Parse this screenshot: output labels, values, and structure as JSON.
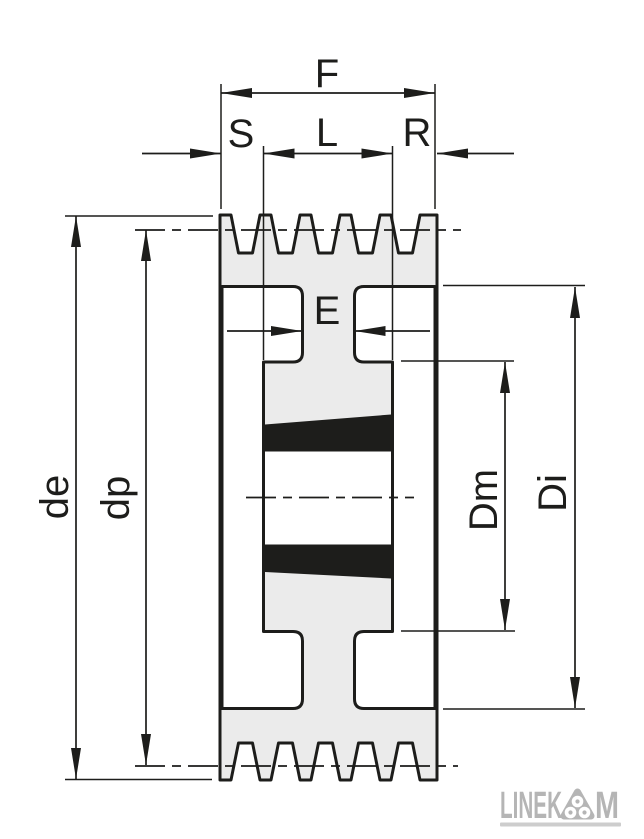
{
  "diagram": {
    "type": "technical-drawing-pulley-section",
    "dimensions": {
      "F": "F",
      "S": "S",
      "L": "L",
      "R": "R",
      "E": "E",
      "de": "de",
      "dp": "dp",
      "Dm": "Dm",
      "Di": "Di"
    },
    "colors": {
      "background": "#ffffff",
      "body_fill": "#ebebeb",
      "line": "#1d1d1b",
      "bushing_fill": "#1d1d1b",
      "bore_fill": "#ffffff",
      "logo_gray": "#b5b5b5",
      "tagline_gray": "#cdcdcd"
    }
  },
  "logo": {
    "text_left": "LINEK",
    "text_right": "M"
  }
}
